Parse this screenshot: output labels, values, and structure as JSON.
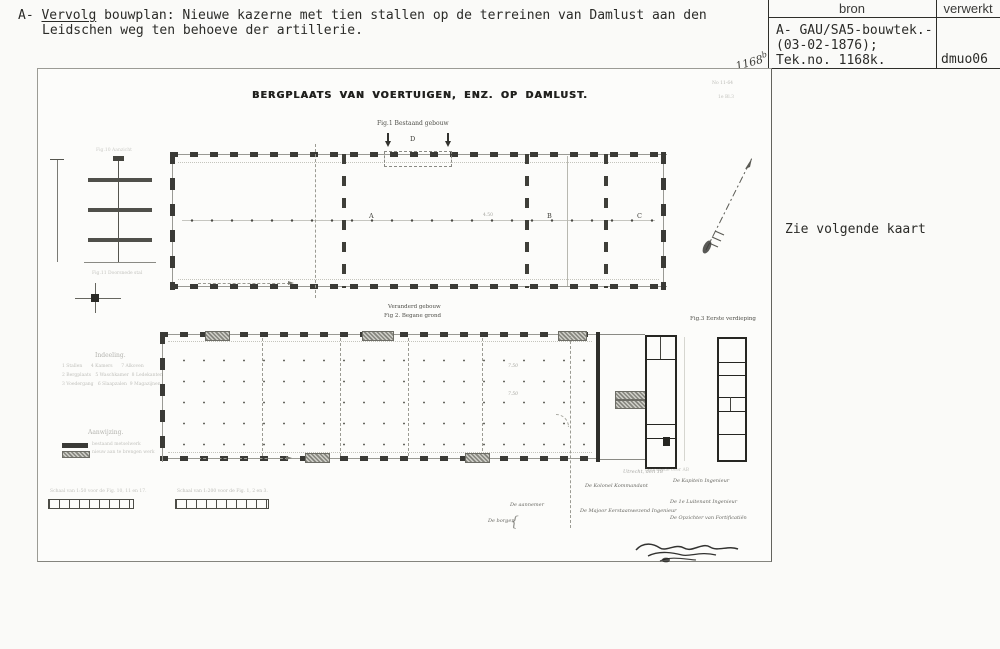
{
  "header": {
    "prefix": "A- ",
    "underlined": "Vervolg",
    "rest": " bouwplan: Nieuwe kazerne met tien stallen op de terreinen van Damlust aan den",
    "line2": "Leidschen weg ten behoeve der artillerie."
  },
  "index_table": {
    "col_bron": "bron",
    "col_verwerkt": "verwerkt",
    "bron_lines": [
      "A- GAU/SA5-bouwtek.-",
      "(03-02-1876);",
      "Tek.no. 1168k."
    ],
    "verwerkt_value": "dmuo06"
  },
  "margin_note": "Zie volgende kaart",
  "sheet": {
    "handwritten_number": "1168",
    "handwritten_suffix": "b",
    "corner_ref_1": "No 11-64",
    "corner_ref_2": "1e Bl.3",
    "title": "BERGPLAATS VAN VOERTUIGEN, ENZ. OP DAMLUST.",
    "fig1": {
      "caption": "Fig.1 Bestaand gebouw",
      "d_label": "D",
      "label_a": "A",
      "label_b": "B",
      "label_c": "C",
      "dim": "4.50"
    },
    "fig2": {
      "caption_line1": "Veranderd gebouw",
      "caption_line2": "Fig 2. Begane grond",
      "dim1": "7.50",
      "dim2": "7.50"
    },
    "fig3": {
      "caption": "Fig.3 Eerste verdieping"
    },
    "details": {
      "fig10_caption": "Fig.10 Aanzicht",
      "fig11_caption": "Fig.11 Doorsnede stal"
    },
    "wing_caption": "Doorsnede over AB",
    "legend_indeeling": {
      "heading": "Indeeling.",
      "rows": [
        "1 Stallen      4 Kamers      7 Alkoven",
        "2 Bergplaats   5 Waschkamer  8 Ledekanten",
        "3 Voedergang   6 Slaapzalen  9 Magazijnen"
      ]
    },
    "legend_verklaring": {
      "heading": "Aanwijzing.",
      "items": [
        "bestaand metselwerk",
        "nieuw aan te brengen werk"
      ]
    },
    "scale_left": "Schaal van 1:50 voor de Fig. 10, 11 en 17.",
    "scale_right": "Schaal van 1:200 voor de Fig. 1, 2 en 3.",
    "officials": {
      "place_date": "Utrecht, den          18",
      "kolonel": "De Kolonel Kommandant",
      "kapitein": "De Kapitein Ingenieur",
      "majoor": "De Majoor Eerstaanwezend Ingenieur",
      "luitenant": "De 1e Luitenant Ingenieur",
      "opzichter": "De Opzichter van Fortificatiën",
      "aannemer": "De aannemer",
      "borgen": "De borgen",
      "brace": "{"
    }
  }
}
